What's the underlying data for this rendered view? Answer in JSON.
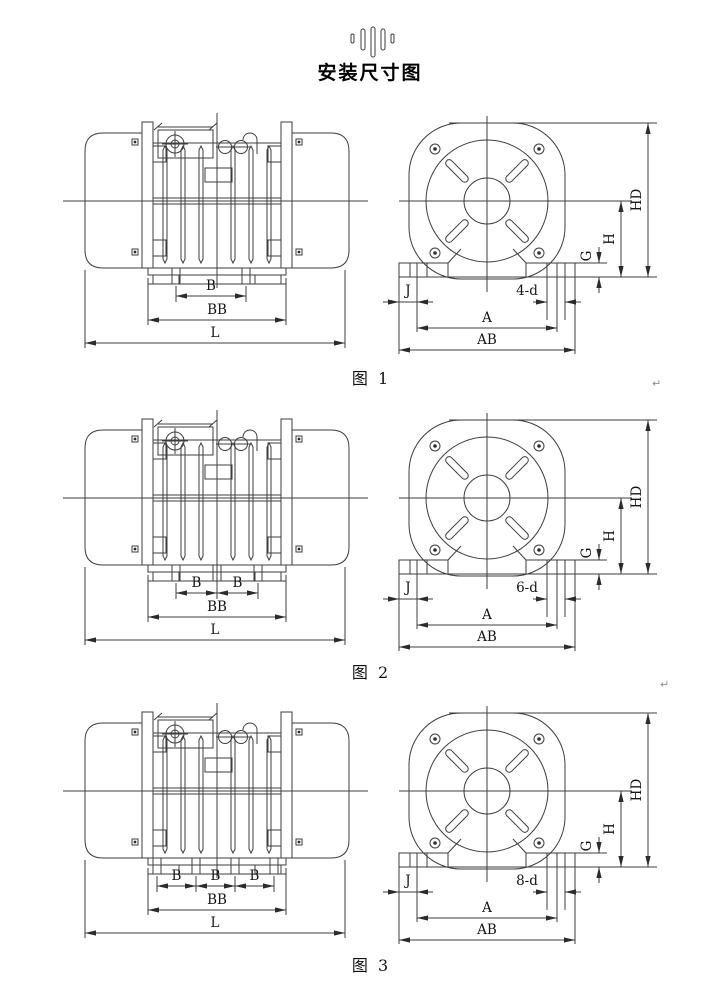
{
  "header": {
    "title": "安装尺寸图",
    "logo_color": "#e32119"
  },
  "dims": {
    "B": "B",
    "BB": "BB",
    "L": "L",
    "A": "A",
    "AB": "AB",
    "J": "J",
    "G": "G",
    "H": "H",
    "HD": "HD"
  },
  "figures": [
    {
      "caption": "图  1",
      "hole_label": "4-d",
      "b_spans": 1
    },
    {
      "caption": "图  2",
      "hole_label": "6-d",
      "b_spans": 2
    },
    {
      "caption": "图  3",
      "hole_label": "8-d",
      "b_spans": 3
    }
  ],
  "artifacts": {
    "return_mark": "↵"
  }
}
